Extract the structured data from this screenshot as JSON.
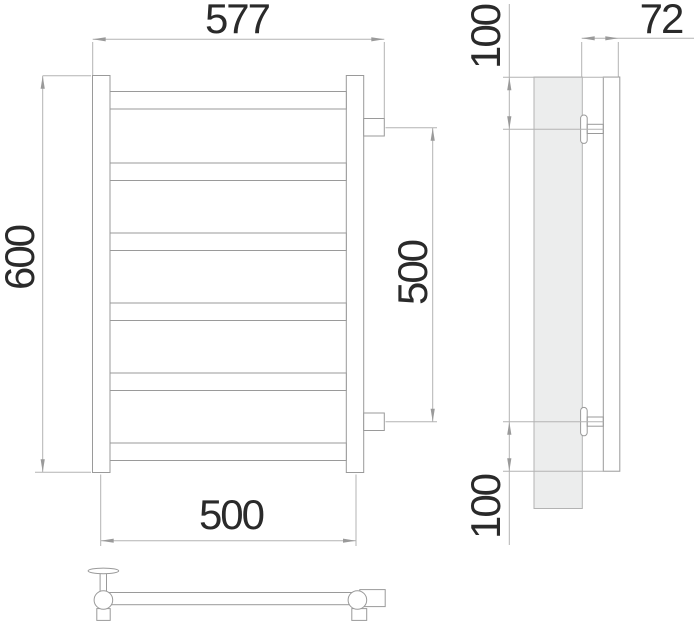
{
  "dimensions": {
    "overall_width": "577",
    "overall_height": "600",
    "connection_spacing": "500",
    "rail_center_width": "500",
    "wall_depth": "72",
    "top_connection_offset": "100",
    "bottom_connection_offset": "100"
  },
  "colors": {
    "object_line": "#9a9a9a",
    "dimension_line": "#b3b3b3",
    "text": "#2a2a2a",
    "wall_plate_fill": "#eceded",
    "background": "#ffffff"
  }
}
